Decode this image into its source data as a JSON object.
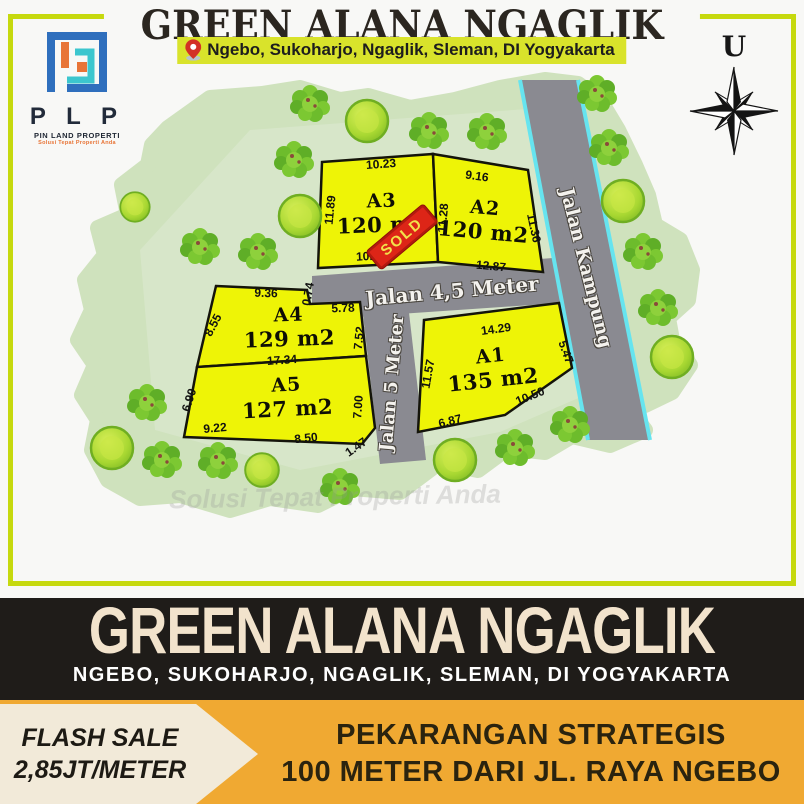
{
  "header": {
    "title": "GREEN ALANA NGAGLIK",
    "location": "Ngebo, Sukoharjo, Ngaglik, Sleman, DI Yogyakarta"
  },
  "brand": {
    "logo_letters": "P L P",
    "logo_name": "PIN LAND PROPERTI",
    "logo_tagline": "Solusi Tepat Properti Anda"
  },
  "compass": {
    "north_label": "U"
  },
  "map": {
    "watermark": "Solusi Tepat Properti Anda",
    "sold_label": "SOLD",
    "roads": {
      "kampung": "Jalan Kampung",
      "road45": "Jalan 4,5 Meter",
      "road5": "Jalan 5 Meter"
    },
    "plots": {
      "a1": {
        "name": "A1",
        "area": "135 m2",
        "m_top": "14.29",
        "m_left": "11.57",
        "m_right": "5.47",
        "m_bottom_right": "10.50",
        "m_bottom_left": "6.87"
      },
      "a2": {
        "name": "A2",
        "area": "120 m2",
        "m_top": "9.16",
        "m_right": "11.36",
        "m_bottom": "12.87",
        "m_shared_left": "11.28"
      },
      "a3": {
        "name": "A3",
        "area": "120 m2",
        "m_top": "10.23",
        "m_left": "11.89",
        "m_bottom": "10.57"
      },
      "a4": {
        "name": "A4",
        "area": "129 m2",
        "m_top": "9.36",
        "m_jog": "0.74",
        "m_top2": "5.78",
        "m_left": "8.55",
        "m_right": "7.52",
        "m_bottom": "17.34"
      },
      "a5": {
        "name": "A5",
        "area": "127 m2",
        "m_left": "6.90",
        "m_bottom_left": "9.22",
        "m_bottom": "8.50",
        "m_right": "7.00",
        "m_corner": "1.47"
      }
    }
  },
  "banner": {
    "title": "GREEN ALANA NGAGLIK",
    "subtitle": "NGEBO, SUKOHARJO, NGAGLIK, SLEMAN, DI YOGYAKARTA"
  },
  "footer": {
    "flash_line1": "FLASH SALE",
    "flash_line2": "2,85JT/METER",
    "right_line1": "PEKARANGAN STRATEGIS",
    "right_line2": "100 METER DARI JL. RAYA NGEBO"
  },
  "colors": {
    "frame_lime": "#c6d90e",
    "badge_lime": "#d9e32b",
    "plot_yellow": "#eef406",
    "road_gray": "#8a8a91",
    "road_edge_cyan": "#66e4ef",
    "map_green": "#cfe2bd",
    "sold_red": "#dd2517",
    "banner_black": "#1f1c19",
    "banner_cream": "#f2e3cc",
    "footer_amber": "#f0a932",
    "flag_cream": "#f2ead9"
  }
}
